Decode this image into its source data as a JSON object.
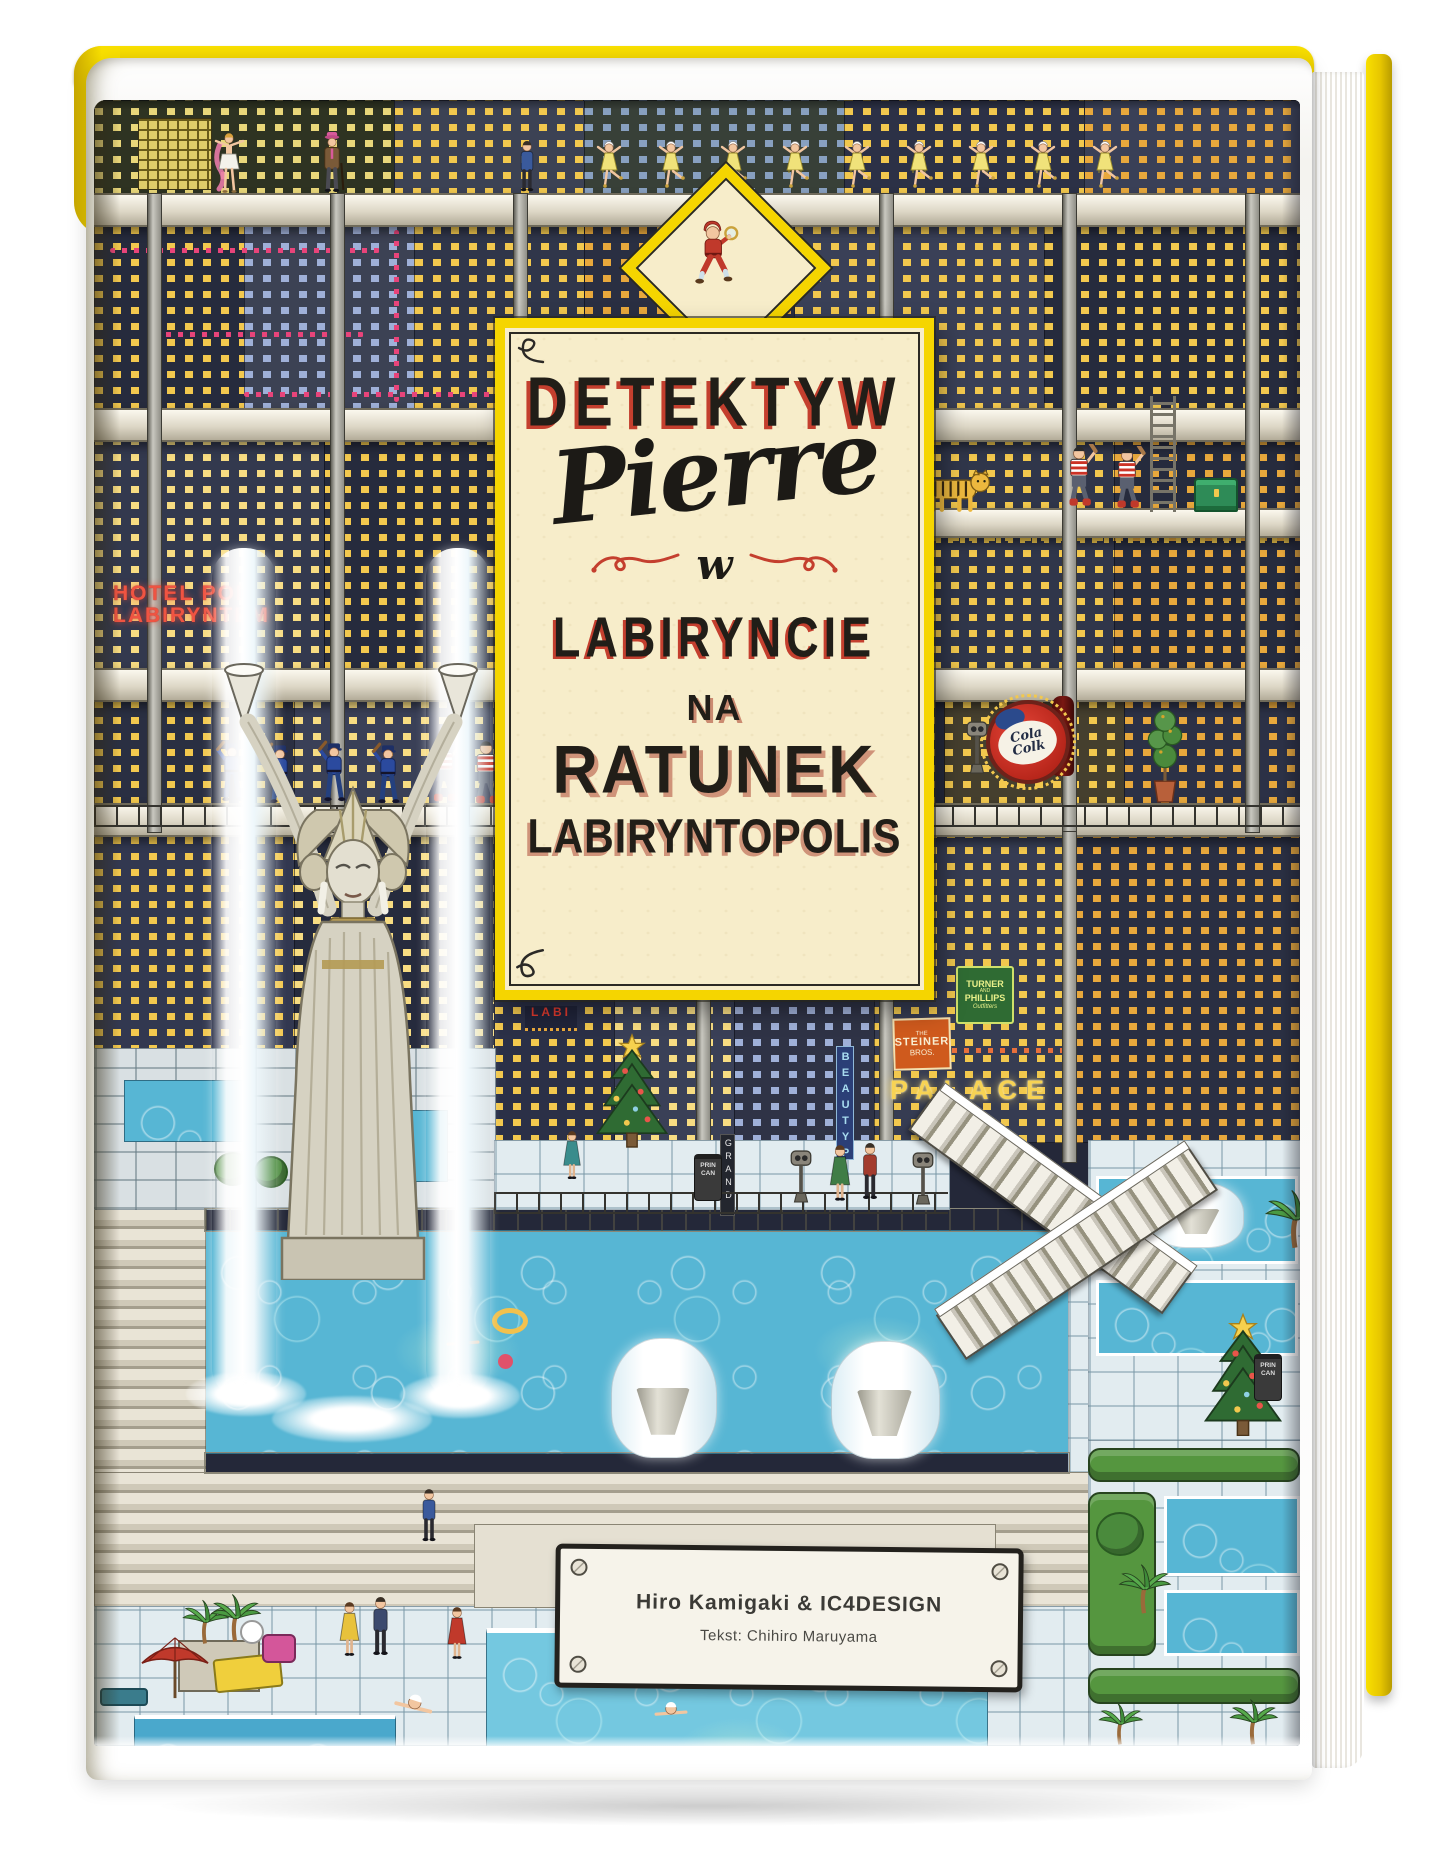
{
  "cover": {
    "title": {
      "prefix": "DETEKTYW",
      "name": "Pierre",
      "connector": "w",
      "location": "LABIRYNCIE",
      "sub1": "NA",
      "sub2": "RATUNEK",
      "sub3": "LABIRYNTOPOLIS"
    },
    "credits": {
      "authors": "Hiro Kamigaki & IC4DESIGN",
      "text_by": "Tekst: Chihiro Maruyama"
    },
    "signs": {
      "hotel_line1": "HOTEL POD",
      "hotel_line2": "LABIRYNTEM",
      "tacos": "TACOS",
      "cola_line1": "Cola",
      "cola_line2": "Colk",
      "turner_line1": "TURNER",
      "turner_line2": "AND",
      "turner_line3": "PHILLIPS",
      "turner_line4": "Outfitters",
      "steiner_line1": "THE",
      "steiner_line2": "STEINER",
      "steiner_line3": "BROS.",
      "palace": "PALACE",
      "beauty": "BEAUTYPA",
      "grand": "GRAND",
      "labi": "LABI",
      "bin_line1": "PRIN",
      "bin_line2": "CAN"
    },
    "colors": {
      "cover_yellow": "#f5d500",
      "panel_cream": "#f7edca",
      "accent_red": "#c43f2e",
      "night_blue": "#242839",
      "pool_blue": "#57b6d4"
    }
  }
}
